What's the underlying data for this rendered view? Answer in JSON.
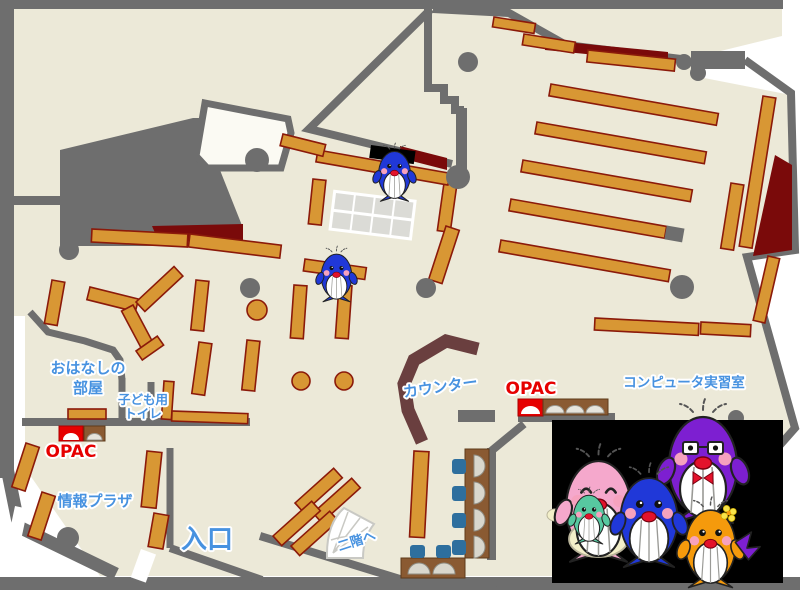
{
  "labels": {
    "ohanashi_room": {
      "line1": "おはなしの",
      "line2": "部屋"
    },
    "kids_toilet": {
      "line1": "子ども用",
      "line2": "トイレ"
    },
    "opac_left": "OPAC",
    "info_plaza": "情報プラザ",
    "entrance": "入口",
    "counter": "カウンター",
    "opac_right": "OPAC",
    "computer_room": "コンピュータ実習室",
    "to_second_floor": "二階へ"
  },
  "colors": {
    "floor": "#ECE9D8",
    "wall": "#6E6E6E",
    "shelf": "#D89734",
    "shelf_border": "#8B1A0A",
    "dark_red": "#7A0A0A",
    "counter": "#6A3F3F",
    "desk": "#8A5A32",
    "chair": "#2E6F9E",
    "label_blue": "#4792E0",
    "label_red": "#E60000",
    "mascot_pink": "#F5A8CC",
    "mascot_purple": "#7D1FD1",
    "mascot_blue": "#2038D8",
    "mascot_orange": "#F59A0C",
    "mascot_teal": "#57C8A0"
  },
  "mascots": [
    {
      "name": "pink-whale-parent",
      "detail": "closed happy eyes, apron, holding baby"
    },
    {
      "name": "teal-whale-baby",
      "detail": "held by pink parent"
    },
    {
      "name": "purple-whale-parent",
      "detail": "glasses, red bow tie"
    },
    {
      "name": "blue-whale-child",
      "detail": "arms raised"
    },
    {
      "name": "orange-whale-child",
      "detail": "yellow flower, purple tail"
    }
  ]
}
